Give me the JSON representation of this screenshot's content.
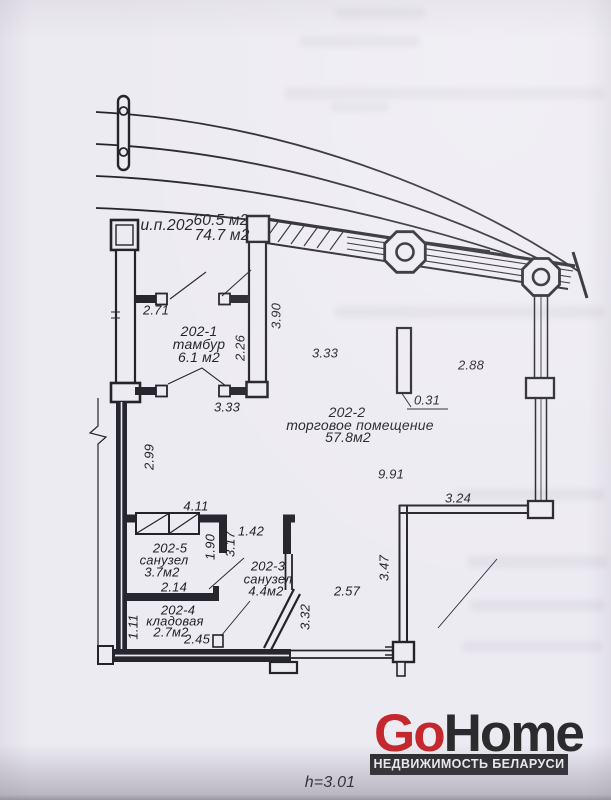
{
  "colors": {
    "paper": "#edebf2",
    "ink": "#23232b",
    "logo_red": "#c4272d",
    "logo_dark": "#2b2b2d"
  },
  "plan": {
    "unit_label": "и.п.202",
    "area_top": "60.5 м2",
    "area_bottom": "74.7 м2",
    "rooms": [
      {
        "id": "202-1",
        "name": "тамбур",
        "area": "6.1 м2"
      },
      {
        "id": "202-2",
        "name": "торговое помещение",
        "area": "57.8м2"
      },
      {
        "id": "202-3",
        "name": "санузел",
        "area": "4.4м2"
      },
      {
        "id": "202-4",
        "name": "кладовая",
        "area": "2.7м2"
      },
      {
        "id": "202-5",
        "name": "санузел",
        "area": "3.7м2"
      }
    ],
    "dims": {
      "w271": "2.71",
      "w333a": "3.33",
      "w226": "2.26",
      "w390": "3.90",
      "w333b": "3.33",
      "w288": "2.88",
      "w031": "0.31",
      "w991": "9.91",
      "w324": "3.24",
      "w299": "2.99",
      "w411": "4.11",
      "w142": "1.42",
      "w190": "1.90",
      "w317": "3.17",
      "w214": "2.14",
      "w347": "3.47",
      "w257": "2.57",
      "w332": "3.32",
      "w111": "1.11",
      "w245": "2.45"
    },
    "ceiling_height": "h=3.01"
  },
  "footer": {
    "brand_first": "Go",
    "brand_second": "Home",
    "tagline": "НЕДВИЖИМОСТЬ БЕЛАРУСИ"
  }
}
